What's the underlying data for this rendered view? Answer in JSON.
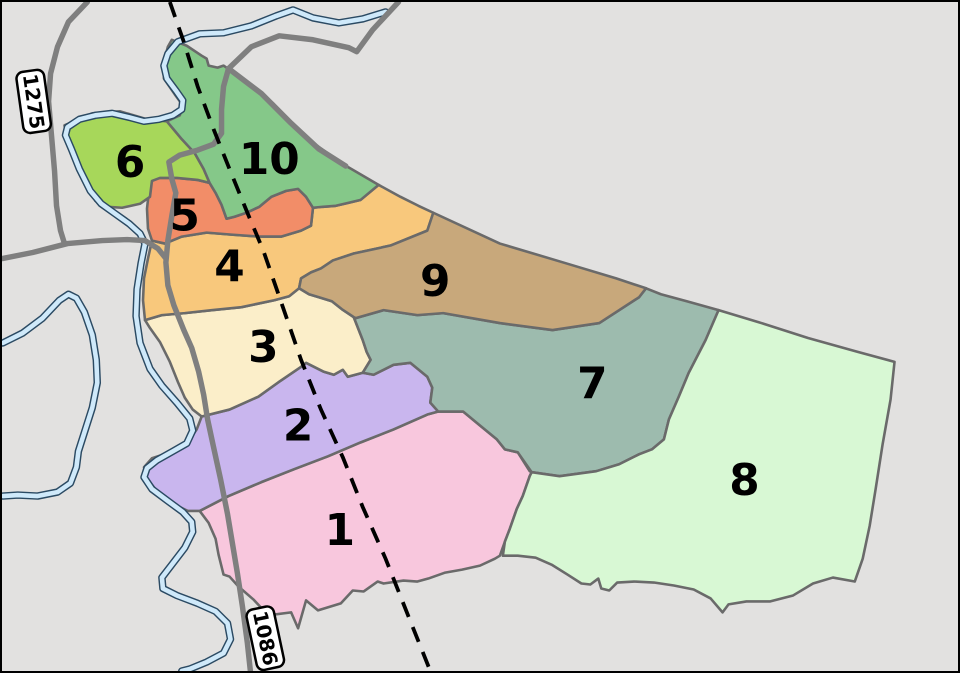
{
  "map": {
    "palette": {
      "background": "#e2e1e0",
      "region_border": "#6a6a6a",
      "road": "#7f7f7f",
      "river_fill": "#cfe9fa",
      "river_outline": "#2b4a63",
      "dashed_boundary": "#000000",
      "shield_background": "#ffffff",
      "shield_border": "#000000",
      "label_color": "#000000"
    },
    "regions": [
      {
        "label": "1",
        "color": "#f8c7dd"
      },
      {
        "label": "2",
        "color": "#c9b6ee"
      },
      {
        "label": "3",
        "color": "#fbeec9"
      },
      {
        "label": "4",
        "color": "#f8c87c"
      },
      {
        "label": "5",
        "color": "#f28d68"
      },
      {
        "label": "6",
        "color": "#a7d75a"
      },
      {
        "label": "7",
        "color": "#9dbbae"
      },
      {
        "label": "8",
        "color": "#d8f8d4"
      },
      {
        "label": "9",
        "color": "#c8a87b"
      },
      {
        "label": "10",
        "color": "#85c889"
      }
    ],
    "road_shields": [
      {
        "label": "1275"
      },
      {
        "label": "1086"
      }
    ]
  }
}
